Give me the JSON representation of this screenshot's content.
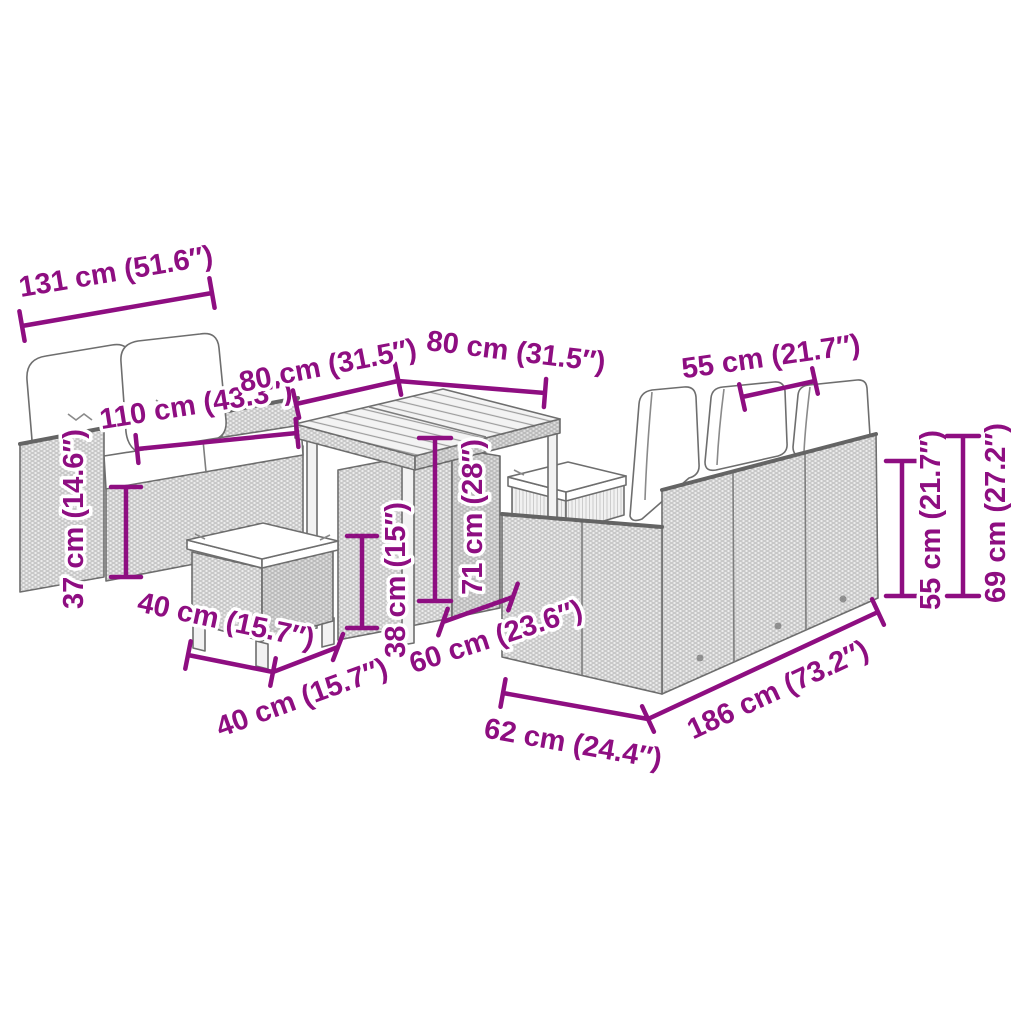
{
  "diagram": {
    "kind": "furniture-dimension-diagram",
    "background_color": "#ffffff",
    "dimension_color": "#8e0e81",
    "items": [
      "loveseat with cushions",
      "square dining table",
      "stool",
      "stool",
      "three-seater sofa with cushions"
    ]
  },
  "dims": {
    "loveseat_width": {
      "label": "131 cm (51.6″)"
    },
    "loveseat_seat_width": {
      "label": "110 cm (43.3″)"
    },
    "loveseat_seat_height": {
      "label": "37 cm (14.6″)"
    },
    "table_length": {
      "label": "80 cm (31.5″)"
    },
    "table_width": {
      "label": "80 cm (31.5″)"
    },
    "table_height": {
      "label": "71 cm (28″)"
    },
    "stool_width": {
      "label": "40 cm (15.7″)"
    },
    "stool_depth": {
      "label": "40 cm (15.7″)"
    },
    "stool_height": {
      "label": "38 cm (15″)"
    },
    "sofa_cushion_width": {
      "label": "55 cm (21.7″)"
    },
    "sofa_seat_depth": {
      "label": "60 cm (23.6″)"
    },
    "sofa_depth": {
      "label": "62 cm (24.4″)"
    },
    "sofa_length": {
      "label": "186 cm (73.2″)"
    },
    "sofa_back_height": {
      "label": "55 cm (21.7″)"
    },
    "sofa_total_height": {
      "label": "69 cm (27.2″)"
    }
  }
}
